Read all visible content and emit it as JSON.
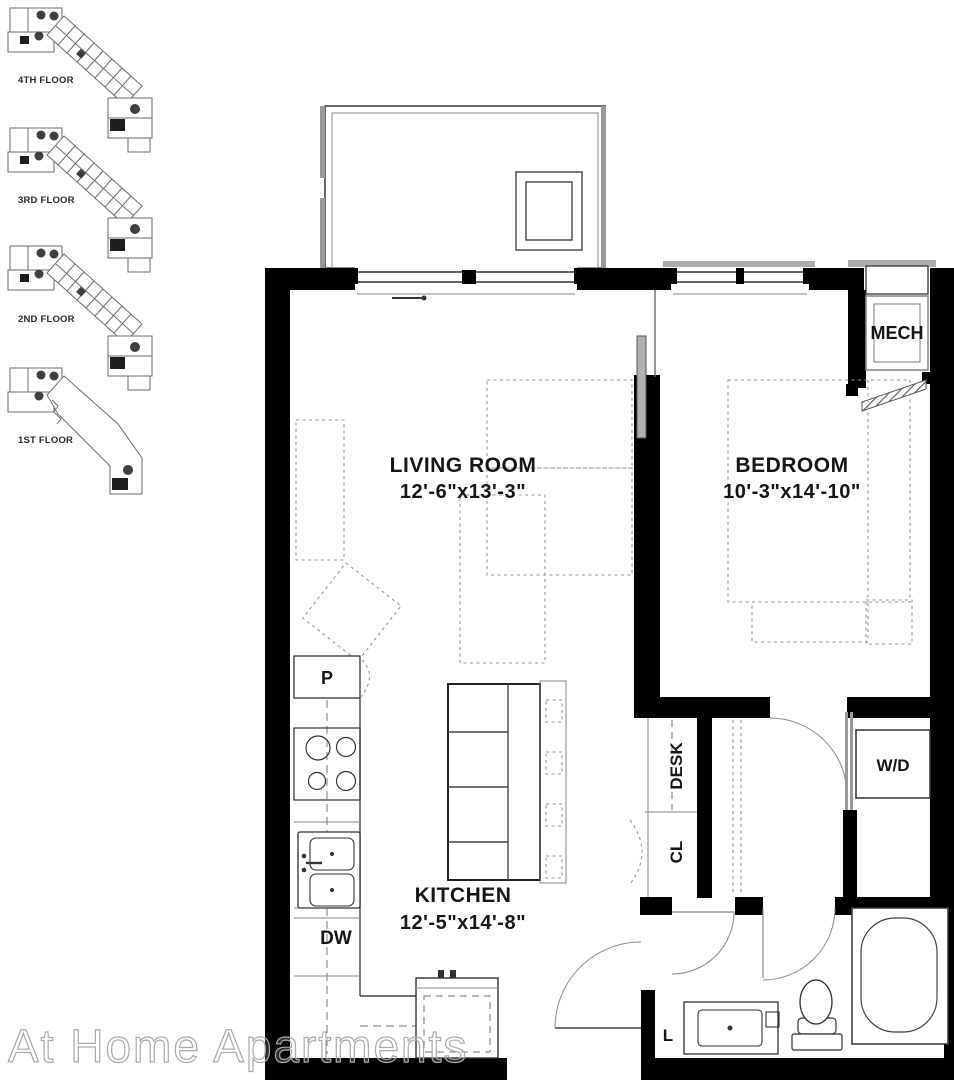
{
  "plan": {
    "keyplans": [
      {
        "label": "4TH FLOOR"
      },
      {
        "label": "3RD FLOOR"
      },
      {
        "label": "2ND FLOOR"
      },
      {
        "label": "1ST FLOOR"
      }
    ],
    "rooms": [
      {
        "name": "LIVING ROOM",
        "dims": "12'-6\"x13'-3\""
      },
      {
        "name": "BEDROOM",
        "dims": "10'-3\"x14'-10\""
      },
      {
        "name": "KITCHEN",
        "dims": "12'-5\"x14'-8\""
      }
    ],
    "fixtures": {
      "mech": "MECH",
      "desk": "DESK",
      "closet": "CL",
      "washer_dryer": "W/D",
      "pantry": "P",
      "dishwasher": "DW",
      "linen": "L"
    }
  },
  "watermark": {
    "text": "At Home Apartments"
  },
  "colors": {
    "wall": "#000000",
    "line": "#444444",
    "furniture_dash": "#979797",
    "keyplan": "#6e6e6e",
    "watermark_stroke": "#ababab"
  }
}
